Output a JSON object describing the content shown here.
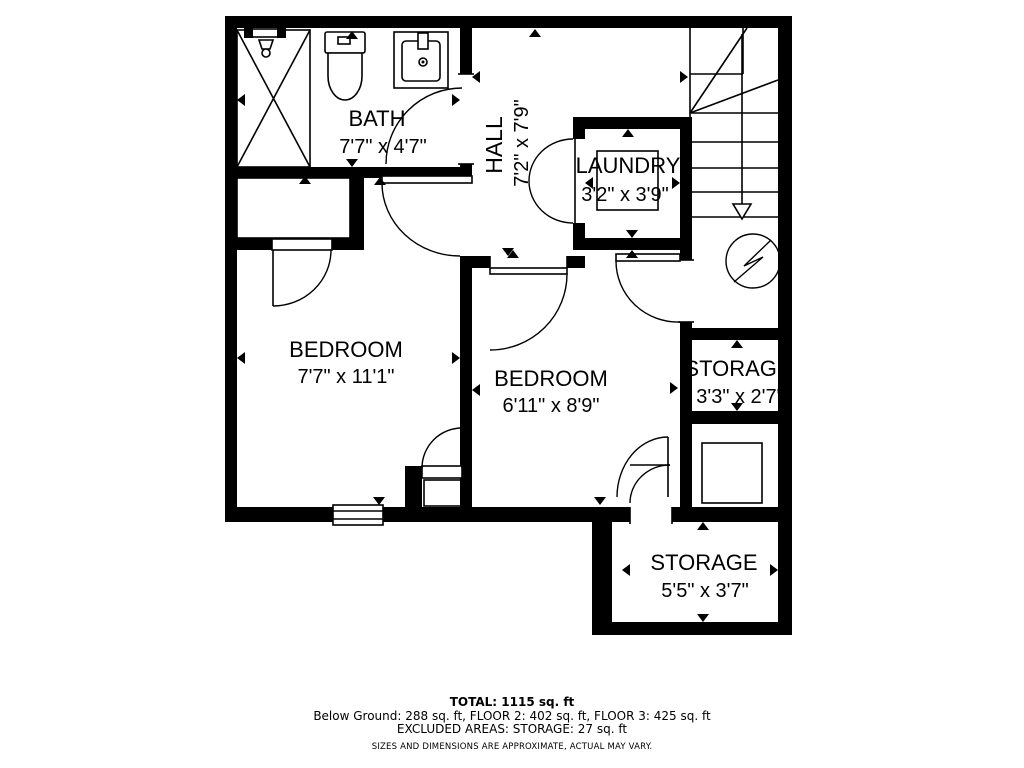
{
  "colors": {
    "wall": "#000000",
    "background": "#ffffff"
  },
  "rooms": {
    "bath": {
      "name": "BATH",
      "dims": "7'7\" x 4'7\""
    },
    "hall": {
      "name": "HALL",
      "dims": "7'2\" x 7'9\""
    },
    "laundry": {
      "name": "LAUNDRY",
      "dims": "3'2\" x 3'9\""
    },
    "bedroom1": {
      "name": "BEDROOM",
      "dims": "7'7\" x 11'1\""
    },
    "bedroom2": {
      "name": "BEDROOM",
      "dims": "6'11\" x 8'9\""
    },
    "storage1": {
      "name": "STORAGE",
      "dims": "3'3\" x 2'7\""
    },
    "storage2": {
      "name": "STORAGE",
      "dims": "5'5\" x 3'7\""
    }
  },
  "footer": {
    "total": "TOTAL: 1115 sq. ft",
    "floors": "Below Ground: 288 sq. ft, FLOOR 2: 402 sq. ft, FLOOR 3: 425 sq. ft",
    "excluded": "EXCLUDED AREAS: STORAGE: 27 sq. ft",
    "disclaimer": "SIZES AND DIMENSIONS ARE APPROXIMATE, ACTUAL MAY VARY."
  }
}
